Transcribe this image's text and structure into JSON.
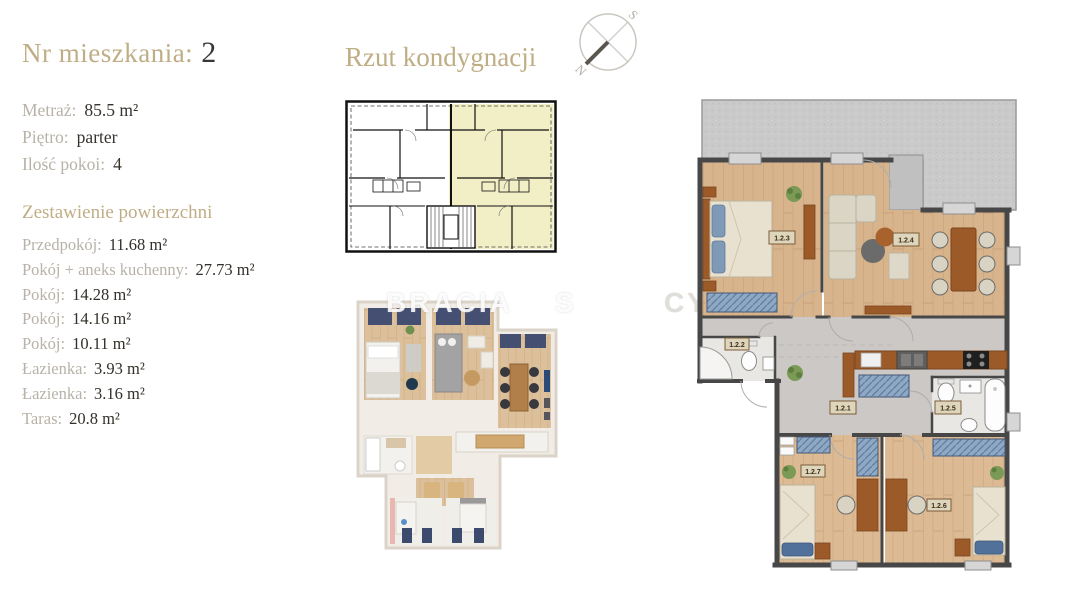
{
  "apartment": {
    "header_label": "Nr mieszkania:",
    "header_number": "2",
    "details": [
      {
        "label": "Metraż:",
        "value": "85.5 m²"
      },
      {
        "label": "Piętro:",
        "value": "parter"
      },
      {
        "label": "Ilość pokoi:",
        "value": "4"
      }
    ],
    "areas_title": "Zestawienie powierzchni",
    "areas": [
      {
        "label": "Przedpokój:",
        "value": "11.68 m²"
      },
      {
        "label": "Pokój + aneks kuchenny:",
        "value": "27.73 m²"
      },
      {
        "label": "Pokój:",
        "value": "14.28 m²"
      },
      {
        "label": "Pokój:",
        "value": "14.16 m²"
      },
      {
        "label": "Pokój:",
        "value": "10.11 m²"
      },
      {
        "label": "Łazienka:",
        "value": "3.93 m²"
      },
      {
        "label": "Łazienka:",
        "value": "3.16 m²"
      },
      {
        "label": "Taras:",
        "value": "20.8 m²"
      }
    ]
  },
  "floor_section": {
    "title": "Rzut kondygnacji"
  },
  "compass": {
    "north": "N",
    "south": "S"
  },
  "watermark": {
    "brand": "BRACIA",
    "brand_suffix": "S",
    "fragment_right": "CY"
  },
  "plan": {
    "room_labels": {
      "hall": "1.2.1",
      "bath_small": "1.2.2",
      "bedroom_master": "1.2.3",
      "living": "1.2.4",
      "bathroom": "1.2.5",
      "bedroom_right": "1.2.6",
      "bedroom_left": "1.2.7"
    }
  },
  "colors": {
    "accent_gold": "#bfae85",
    "text_muted": "#b8b2a8",
    "text_dark": "#37332d",
    "highlight_yellow": "#f2eec6",
    "wood_floor": "#d8b48c",
    "navy_furniture": "#51719a",
    "terrace_gray": "#cacaca",
    "wall_gray": "#474747",
    "furniture_brown": "#9c5a28"
  }
}
